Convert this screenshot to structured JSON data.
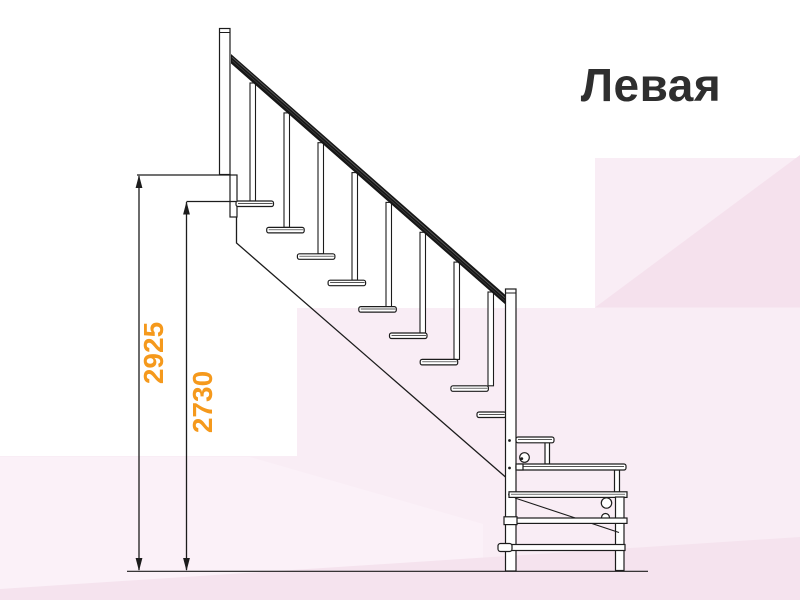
{
  "title": {
    "text": "Левая"
  },
  "dimensions": {
    "overall_height": {
      "value": "2925"
    },
    "flight_height": {
      "value": "2730"
    }
  },
  "drawing": {
    "subject": "staircase-side-view",
    "treads_main_flight": 9,
    "balusters": 8,
    "lower_landing_steps": 2
  },
  "colors": {
    "dimension_text": "#F5991C",
    "title_text": "#2E2E2E",
    "line": "#1C1C1C",
    "handrail": "#161616",
    "background": "#FFFFFF",
    "background_pink_light": "#F9EDF5",
    "background_pink_dark": "#F5E1ED"
  }
}
